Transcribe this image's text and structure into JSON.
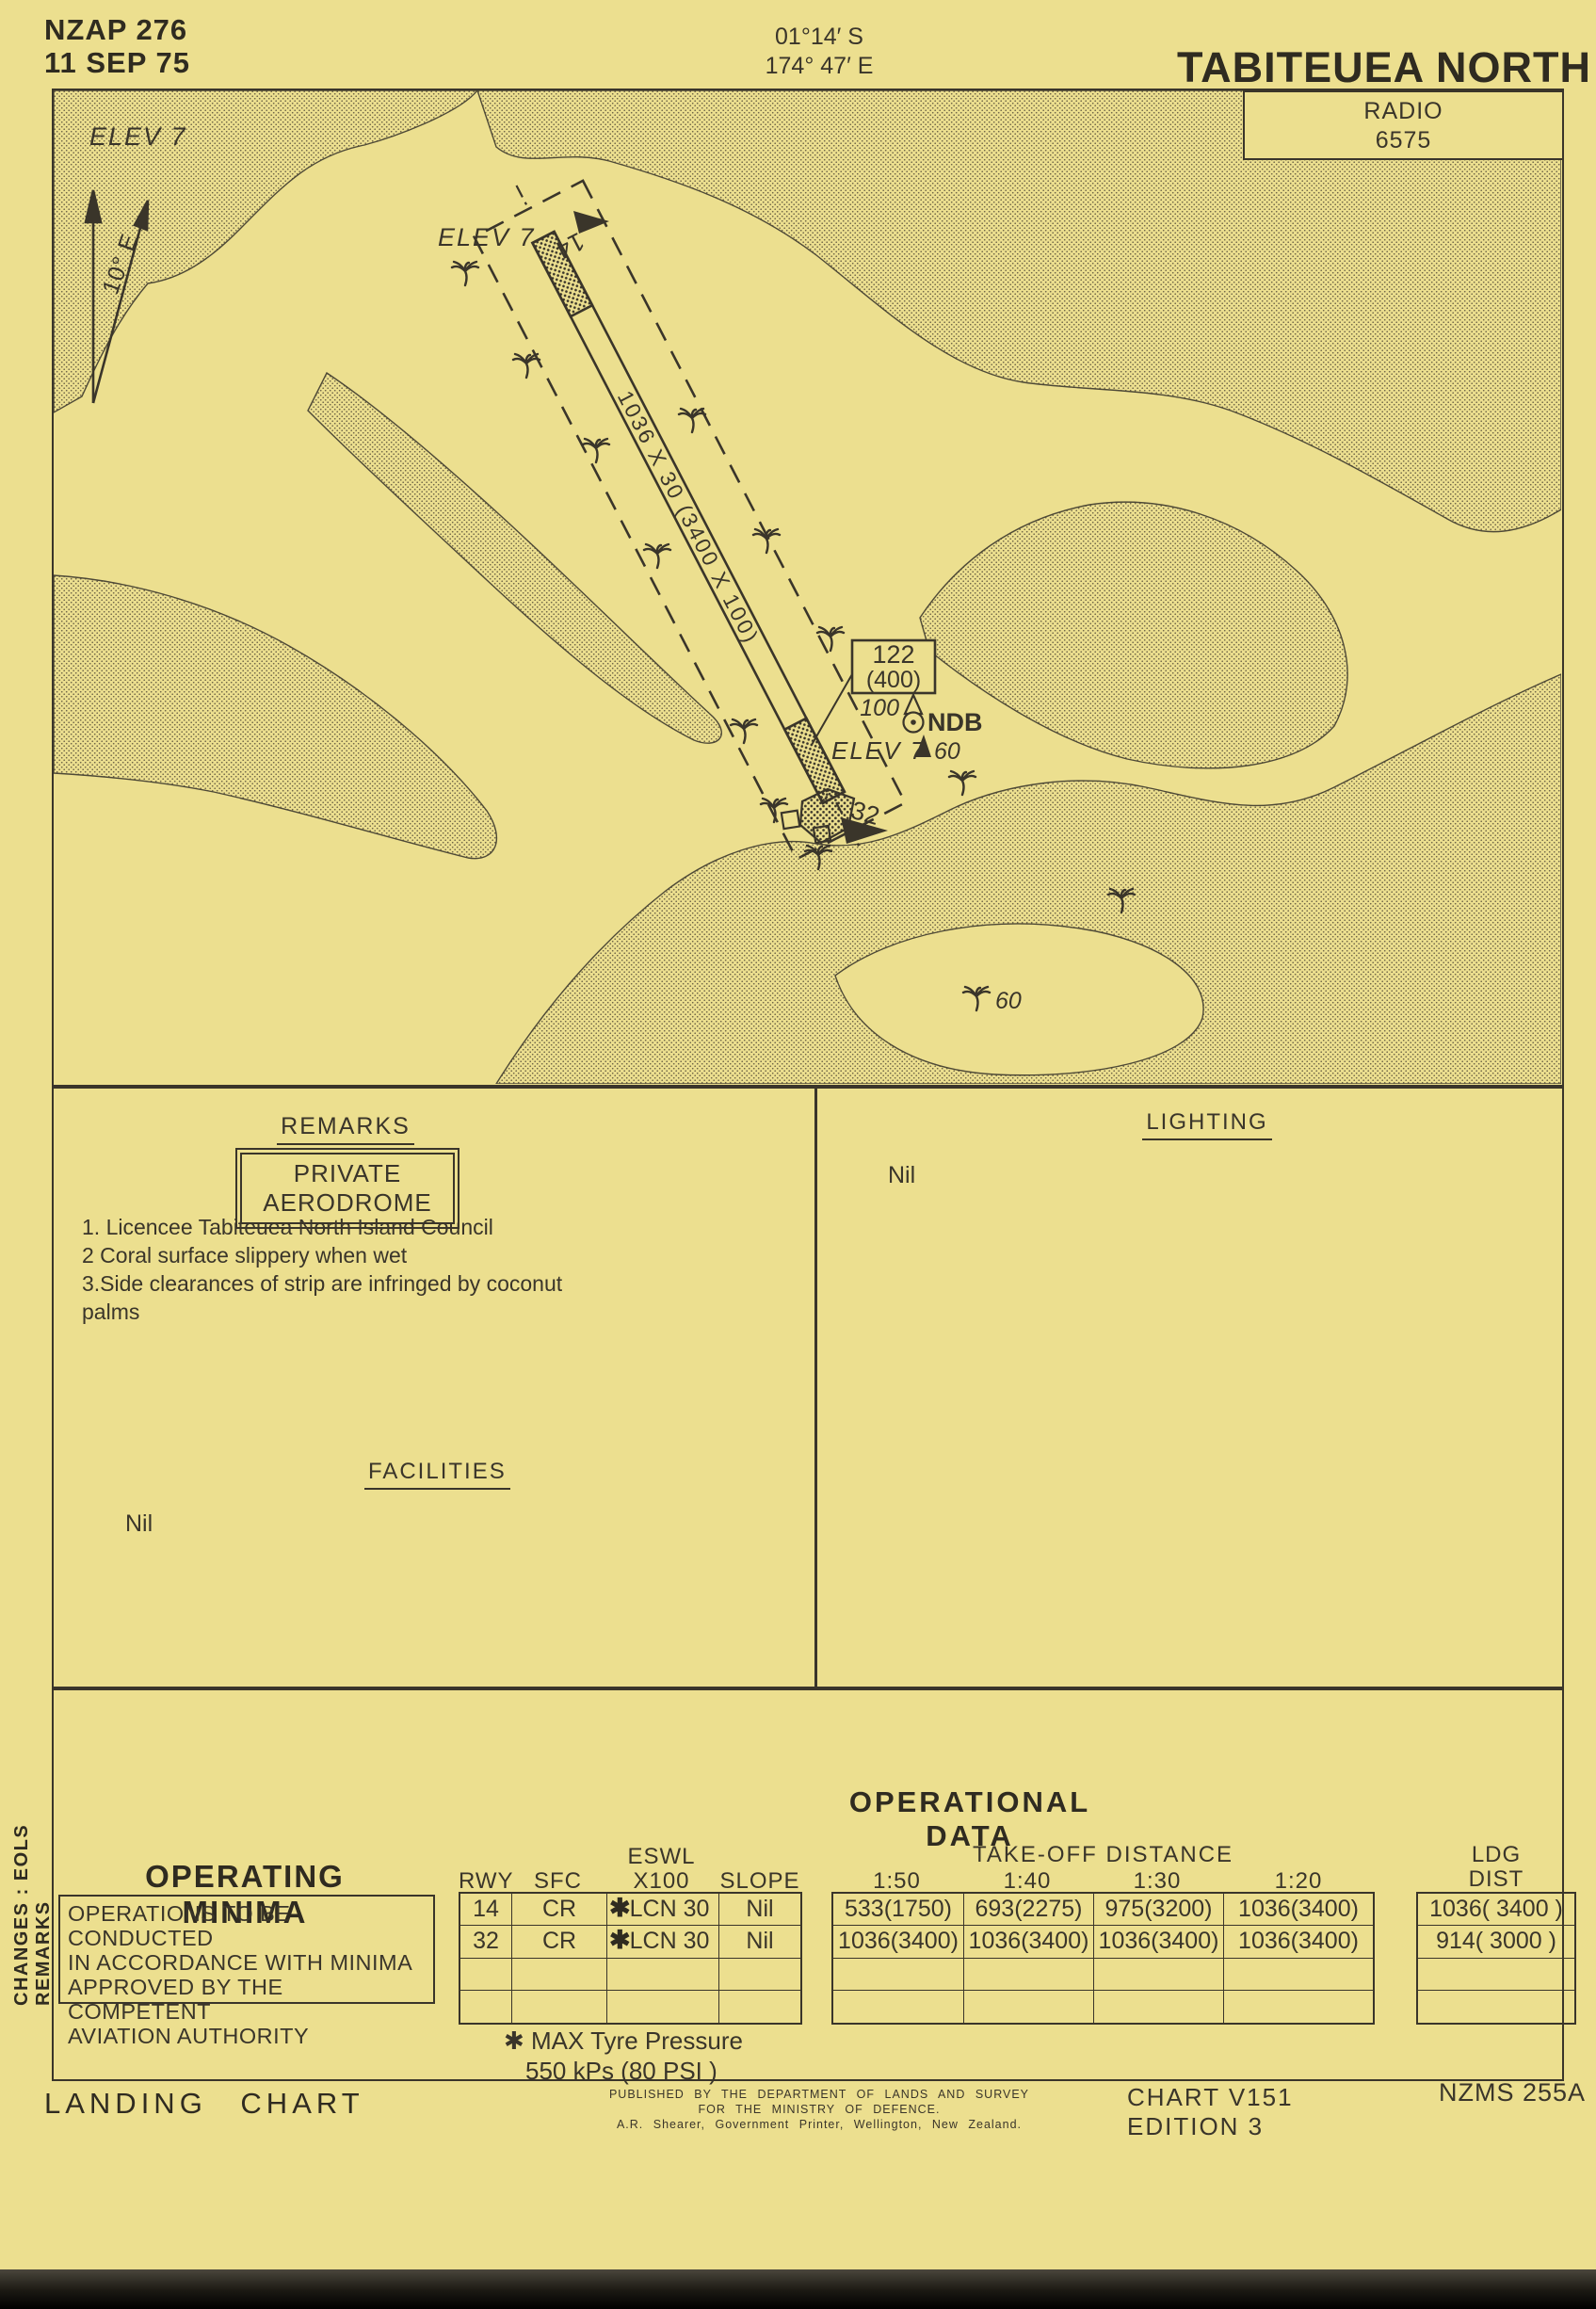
{
  "header": {
    "chart_ref": "NZAP 276",
    "date": "11 SEP 75",
    "lat": "01°14′ S",
    "lon": "174° 47′ E",
    "title": "TABITEUEA NORTH",
    "radio_label": "RADIO",
    "radio_freq": "6575"
  },
  "map": {
    "elev_topleft": "ELEV 7",
    "variation": "10° E",
    "elev_threshold": "ELEV 7",
    "rwy14": "14",
    "rwy32": "32",
    "runway_dims": "1036 X 30 (3400 X 100)",
    "obstacle_box": {
      "line1": "122",
      "line2": "(400)"
    },
    "ndb": {
      "height": "100",
      "label": "NDB",
      "elev": "ELEV 7",
      "tree_height": "60"
    },
    "tree_height_south": "60"
  },
  "remarks": {
    "heading": "REMARKS",
    "boxed_note": "PRIVATE AERODROME",
    "items": [
      "1.  Licencee Tabiteuea North Island Council",
      "2  Coral surface slippery when wet",
      "3.Side clearances of strip are infringed by coconut palms"
    ]
  },
  "facilities": {
    "heading": "FACILITIES",
    "value": "Nil"
  },
  "lighting": {
    "heading": "LIGHTING",
    "value": "Nil"
  },
  "sidebar_vertical": "CHANGES : EOLS REMARKS",
  "operating_minima": {
    "heading": "OPERATING MINIMA",
    "lines": [
      "OPERATIONS TO BE CONDUCTED",
      "IN ACCORDANCE WITH MINIMA",
      "APPROVED BY THE COMPETENT",
      "AVIATION AUTHORITY"
    ]
  },
  "operational_data": {
    "heading": "OPERATIONAL DATA",
    "headers": {
      "rwy": "RWY",
      "sfc": "SFC",
      "eswl1": "ESWL",
      "eswl2": "X100",
      "slope": "SLOPE",
      "takeoff": "TAKE-OFF DISTANCE",
      "r50": "1:50",
      "r40": "1:40",
      "r30": "1:30",
      "r20": "1:20",
      "ldg1": "LDG",
      "ldg2": "DIST"
    },
    "rows": [
      {
        "rwy": "14",
        "sfc": "CR",
        "star": "✱",
        "eswl": "LCN 30",
        "slope": "Nil",
        "t50": "533(1750)",
        "t40": "693(2275)",
        "t30": "975(3200)",
        "t20": "1036(3400)",
        "ldg": "1036( 3400 )"
      },
      {
        "rwy": "32",
        "sfc": "CR",
        "star": "✱",
        "eswl": "LCN 30",
        "slope": "Nil",
        "t50": "1036(3400)",
        "t40": "1036(3400)",
        "t30": "1036(3400)",
        "t20": "1036(3400)",
        "ldg": "914( 3000 )"
      }
    ],
    "note1": "✱ MAX Tyre Pressure",
    "note2": "550 kPs (80 PSI )"
  },
  "footer": {
    "doc_type": "LANDING CHART",
    "publisher_line1": "PUBLISHED BY THE DEPARTMENT OF LANDS AND SURVEY",
    "publisher_line2": "FOR THE MINISTRY OF DEFENCE.",
    "publisher_line3": "A.R. Shearer, Government Printer, Wellington, New Zealand.",
    "chart_number": "CHART V151",
    "edition": "EDITION 3",
    "series_ref": "NZMS 255A"
  }
}
